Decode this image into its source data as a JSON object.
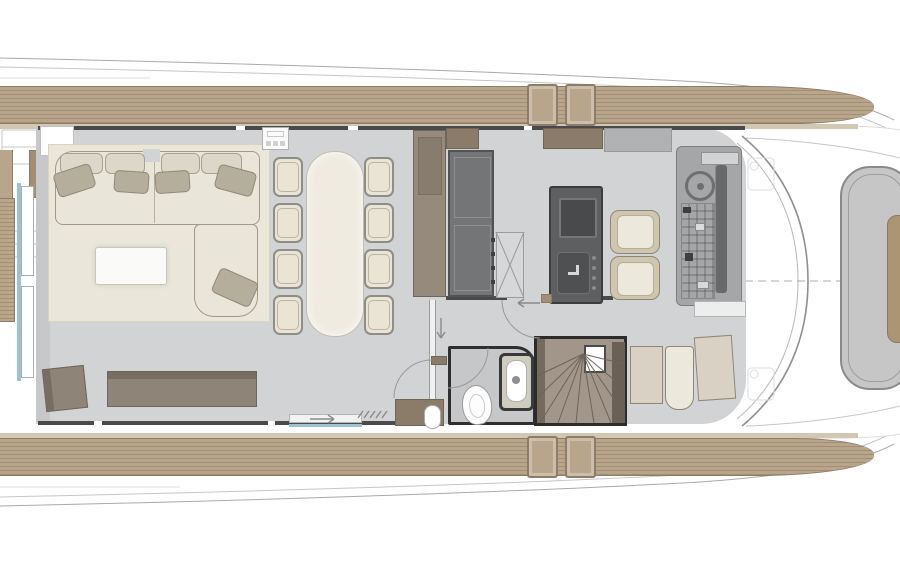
{
  "meta": {
    "title": "Motor yacht main deck floor plan",
    "canvas": {
      "width": 900,
      "height": 564
    },
    "visible_text": []
  },
  "colors": {
    "line": "#a9a9a9",
    "lineLight": "#c6c6c6",
    "lineFaint": "#dddddd",
    "windshield": "#8f8f8f",
    "windshieldInner": "#b8b8b8",
    "dash": "#ababab",
    "doorArc": "#9a9a9a",
    "tread": "#6f6458",
    "mark": "#8a8a8a",
    "deck": "#b7a58c",
    "deckStripe": "#a28f75",
    "deckEdge": "#8d7d66",
    "deckTrim": "#d2c7b2",
    "floor": "#d2d3d5",
    "floorDark": "#c7c8ca",
    "wall": "#4a4a4a",
    "wallBrown": "#8b7c6a",
    "cream": "#e9e5d8",
    "creamDark": "#dcd7c8",
    "creamBorder": "#a09a8a",
    "pillow": "#b6ae9c",
    "pillowBorder": "#8f897a",
    "table": "#efebe0",
    "tableBorder": "#c2bdae",
    "chair": "#e9e4d4",
    "chairBorder": "#8e8e88",
    "taupe": "#8f8478",
    "taupeDark": "#6e655b",
    "galleyUnit": "#737577",
    "galleyUnitLine": "#8d8f91",
    "island": "#5d5f61",
    "islandDark": "#484a4c",
    "islandBorder": "#3a3c3e",
    "consoleBase": "#a4a6a8",
    "consoleDark": "#67696b",
    "seatFrame": "#cfc6b0",
    "seatCushion": "#ece8db",
    "stairs": "#a2968a",
    "stairsDark": "#6b6056",
    "stairsBorder": "#2b2b2b",
    "bath": "#c6c7c9",
    "bathBorder": "#2f2f2f",
    "glass": "#9cc3d2",
    "sunpad": "#c6c6c6",
    "sunpadBorder": "#8a8a8a",
    "sunpadInsert": "#ab9572",
    "beige": "#d9d2c4",
    "beigeBorder": "#8f8678"
  },
  "plan": {
    "vessel": "motor yacht — main deck, bow to the right",
    "areas": [
      {
        "name": "aft-deck"
      },
      {
        "name": "salon"
      },
      {
        "name": "dining-area"
      },
      {
        "name": "galley"
      },
      {
        "name": "day-head"
      },
      {
        "name": "helm-station"
      },
      {
        "name": "staircase-down"
      },
      {
        "name": "port-side-deck"
      },
      {
        "name": "starboard-side-deck"
      },
      {
        "name": "foredeck-sunpad"
      }
    ],
    "inventory": {
      "salon": [
        "l-shaped-sofa",
        "chaise-section",
        "back-cushions",
        "throw-pillows",
        "coffee-table",
        "rug",
        "sideboard",
        "aft-cabinet"
      ],
      "dining": [
        "dining-table",
        "dining-chairs",
        "bar-cabinet",
        "tall-cabinet"
      ],
      "galley": [
        "appliance-wall-unit",
        "pantry-locker",
        "island-with-cooktop-and-sink"
      ],
      "helm": [
        "console-with-wheel",
        "instrument-panel",
        "helm-seats"
      ],
      "day_head": [
        "toilet",
        "vanity-sink"
      ],
      "counts": {
        "dining_chairs": 8,
        "helm_seats": 2,
        "sofa_back_cushions": 4,
        "throw_pillows": 5,
        "deck_step_boxes": 4,
        "stair_treads": 10
      }
    }
  }
}
